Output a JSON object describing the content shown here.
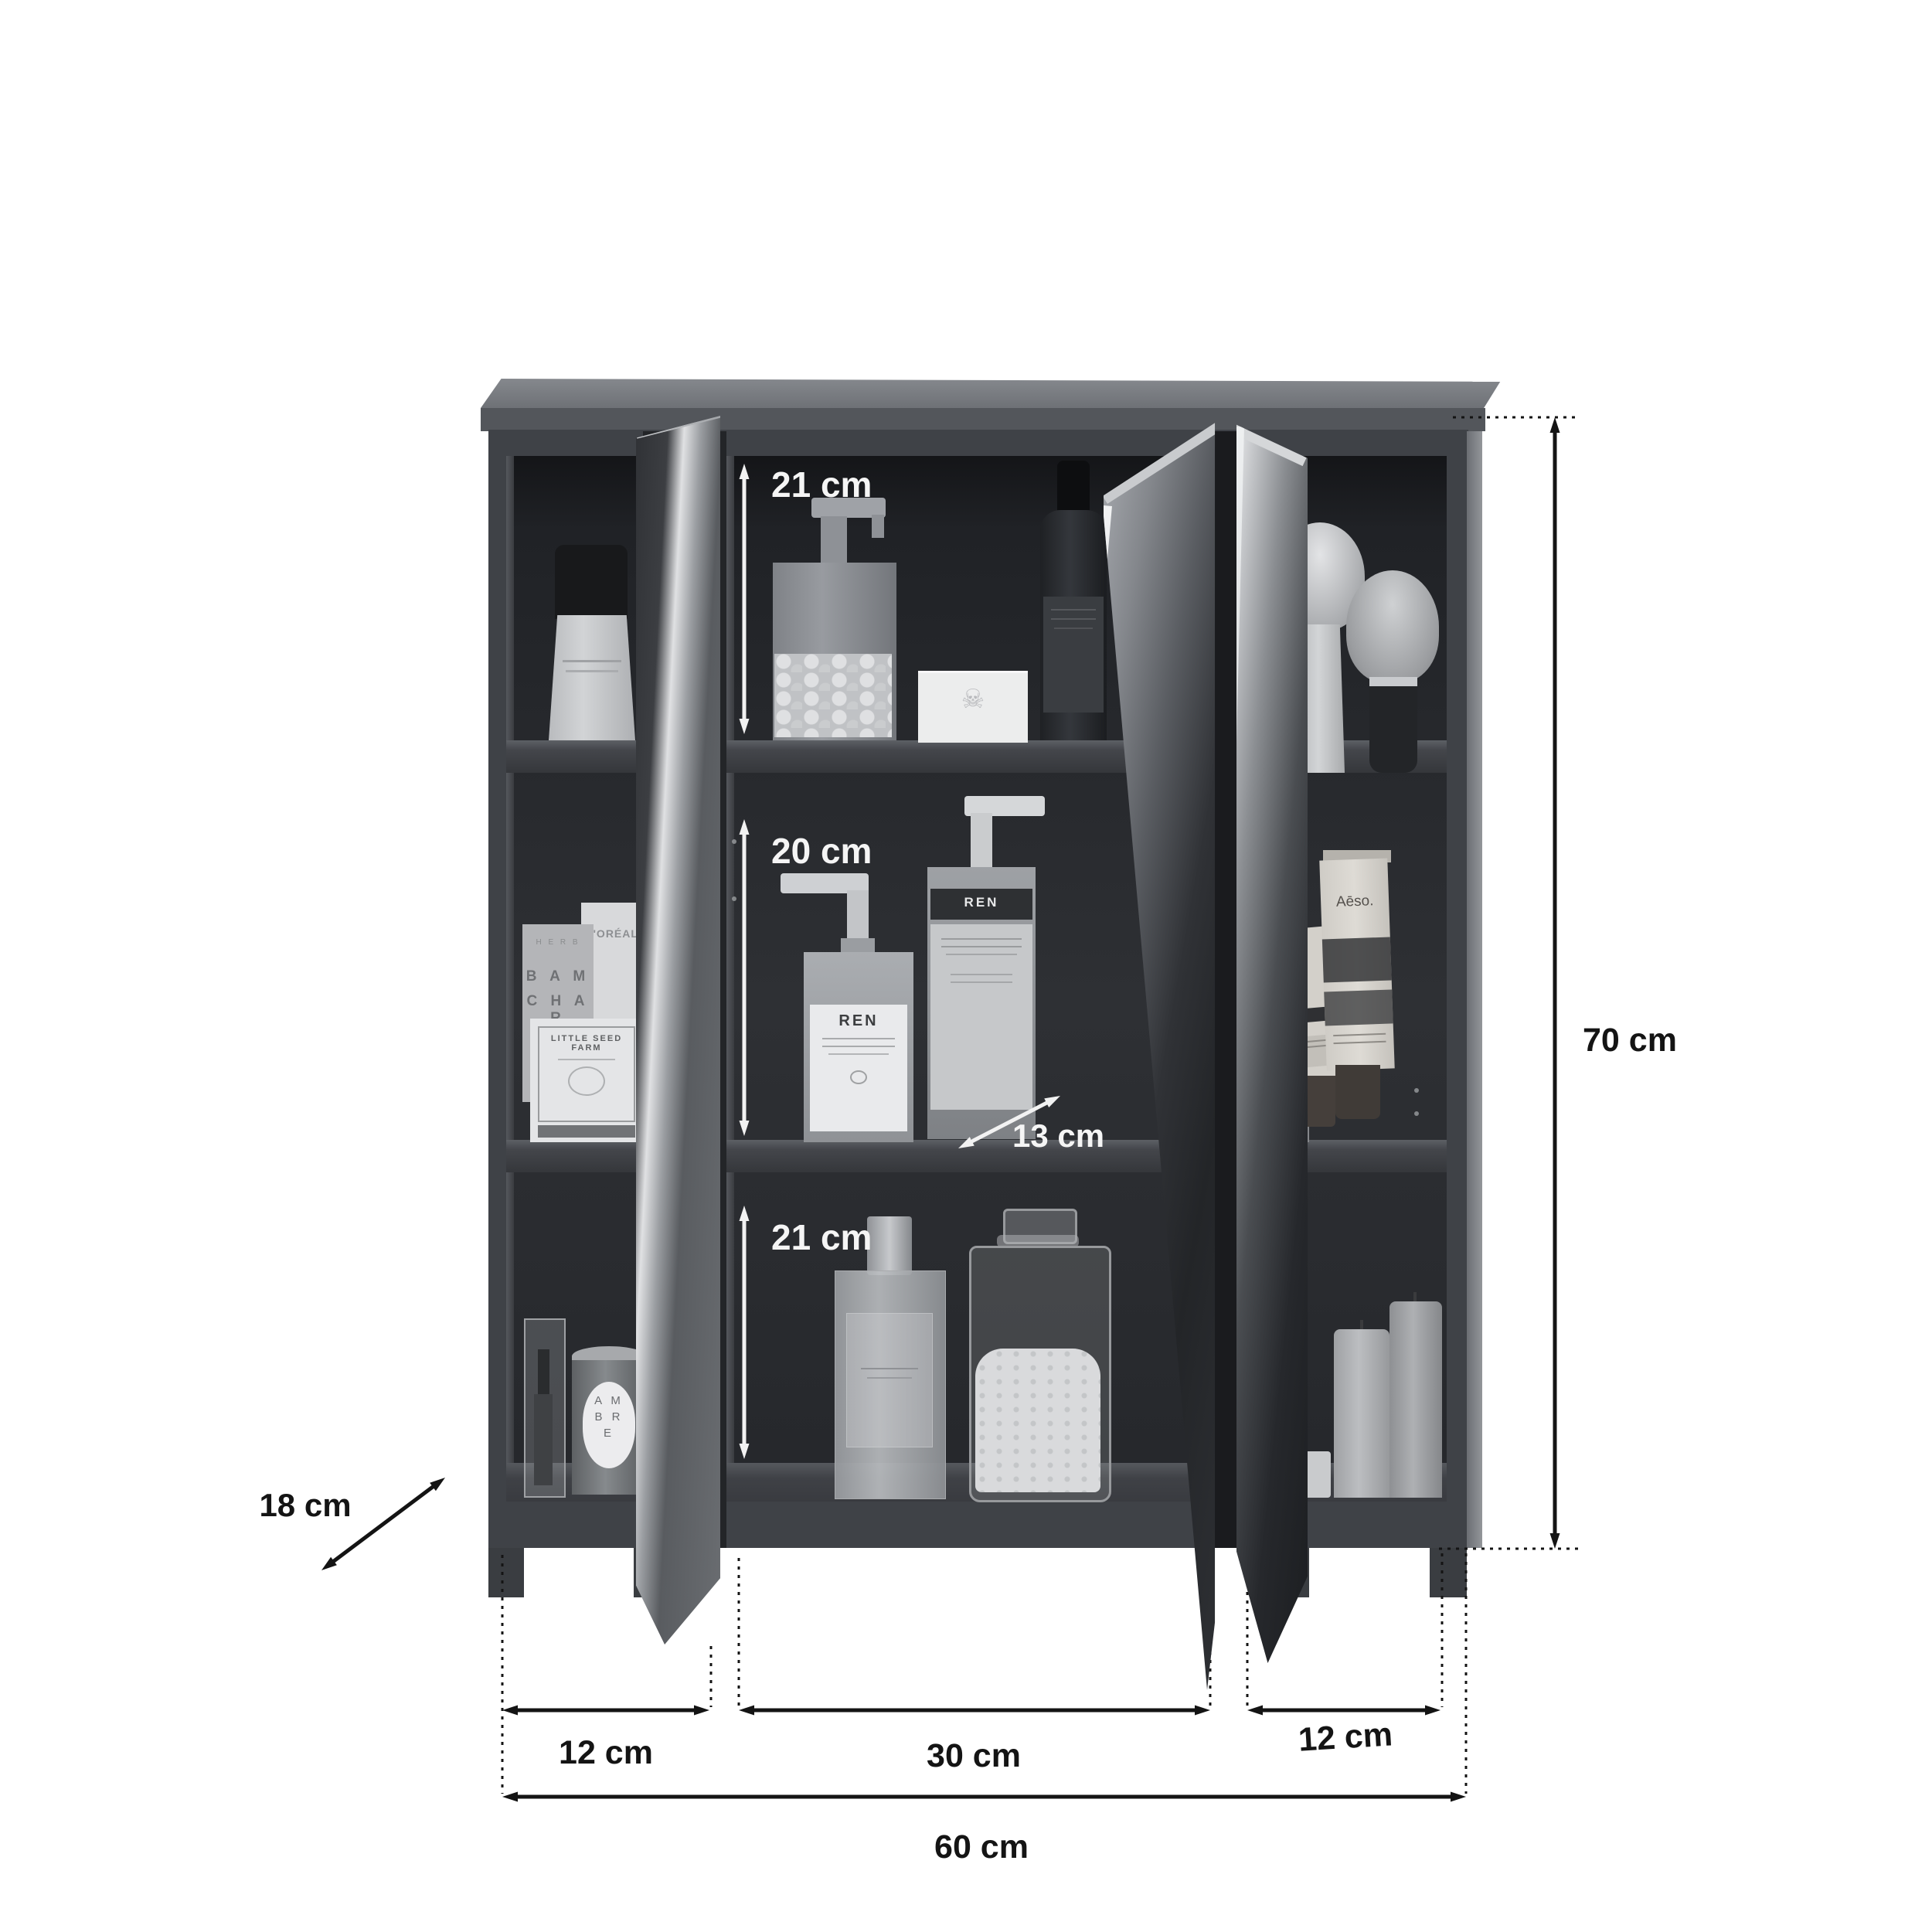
{
  "title": "Mirrored bathroom wall cabinet dimension diagram",
  "dimensions": {
    "top_compartment_height": "21 cm",
    "middle_compartment_height": "20 cm",
    "bottom_compartment_height": "21 cm",
    "shelf_depth": "13 cm",
    "cabinet_height": "70 cm",
    "cabinet_depth": "18 cm",
    "left_section_width": "12 cm",
    "middle_section_width": "30 cm",
    "right_section_width": "12 cm",
    "cabinet_width": "60 cm"
  },
  "products": {
    "herb_box_tiny": "H E R B",
    "herb_box_line1": "B A M",
    "herb_box_line2": "C H A R",
    "loreal_box": "L'ORÉAL",
    "soap_box": "LITTLE SEED FARM",
    "candle_line1": "A M",
    "candle_line2": "B R",
    "candle_line3": "E",
    "skull_icon": "☠",
    "ren_front": "REN",
    "ren_back": "REN",
    "aesop_tube": "Aēso."
  },
  "colors": {
    "cabinet_front": "#3f4247",
    "interior": "#2a2c30",
    "inner_dim_text": "#f5f5f5",
    "outer_dim_text": "#141414",
    "background": "#ffffff"
  }
}
